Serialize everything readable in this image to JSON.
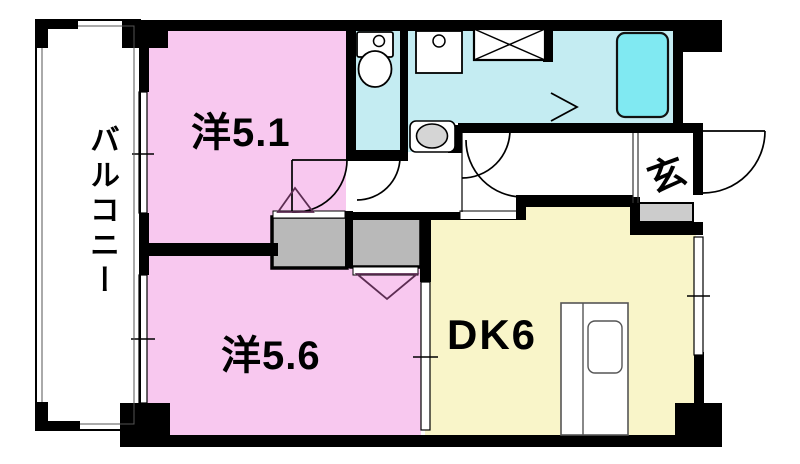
{
  "floorplan": {
    "type": "Japanese apartment floor plan (2DK)",
    "balcony": {
      "label": "バルコニー"
    },
    "rooms": [
      {
        "id": "western-room-5-1",
        "label": "洋5.1",
        "kind": "western-style room 5.1 tatami"
      },
      {
        "id": "western-room-5-6",
        "label": "洋5.6",
        "kind": "western-style room 5.6 tatami"
      },
      {
        "id": "dining-kitchen",
        "label": "DK6",
        "kind": "dining kitchen 6 tatami"
      },
      {
        "id": "entrance",
        "label": "玄",
        "kind": "genkan entrance"
      }
    ],
    "fixtures": [
      "toilet",
      "vanity-basin",
      "washing-machine-pan",
      "washbasin-pedestal",
      "bathtub",
      "kitchen-counter",
      "kitchen-sink",
      "closet-upper",
      "closet-lower",
      "entrance-step",
      "entrance-door",
      "sliding-window",
      "sliding-partition"
    ],
    "colors": {
      "room_pink": "#f8c8ef",
      "room_yellow": "#f9f5c9",
      "wet_area_cyan": "#c4ecf2",
      "bathtub_cyan": "#80e9f2",
      "closet_gray": "#b9b9b9",
      "step_gray": "#cccccc",
      "wall_black": "#000000"
    }
  }
}
